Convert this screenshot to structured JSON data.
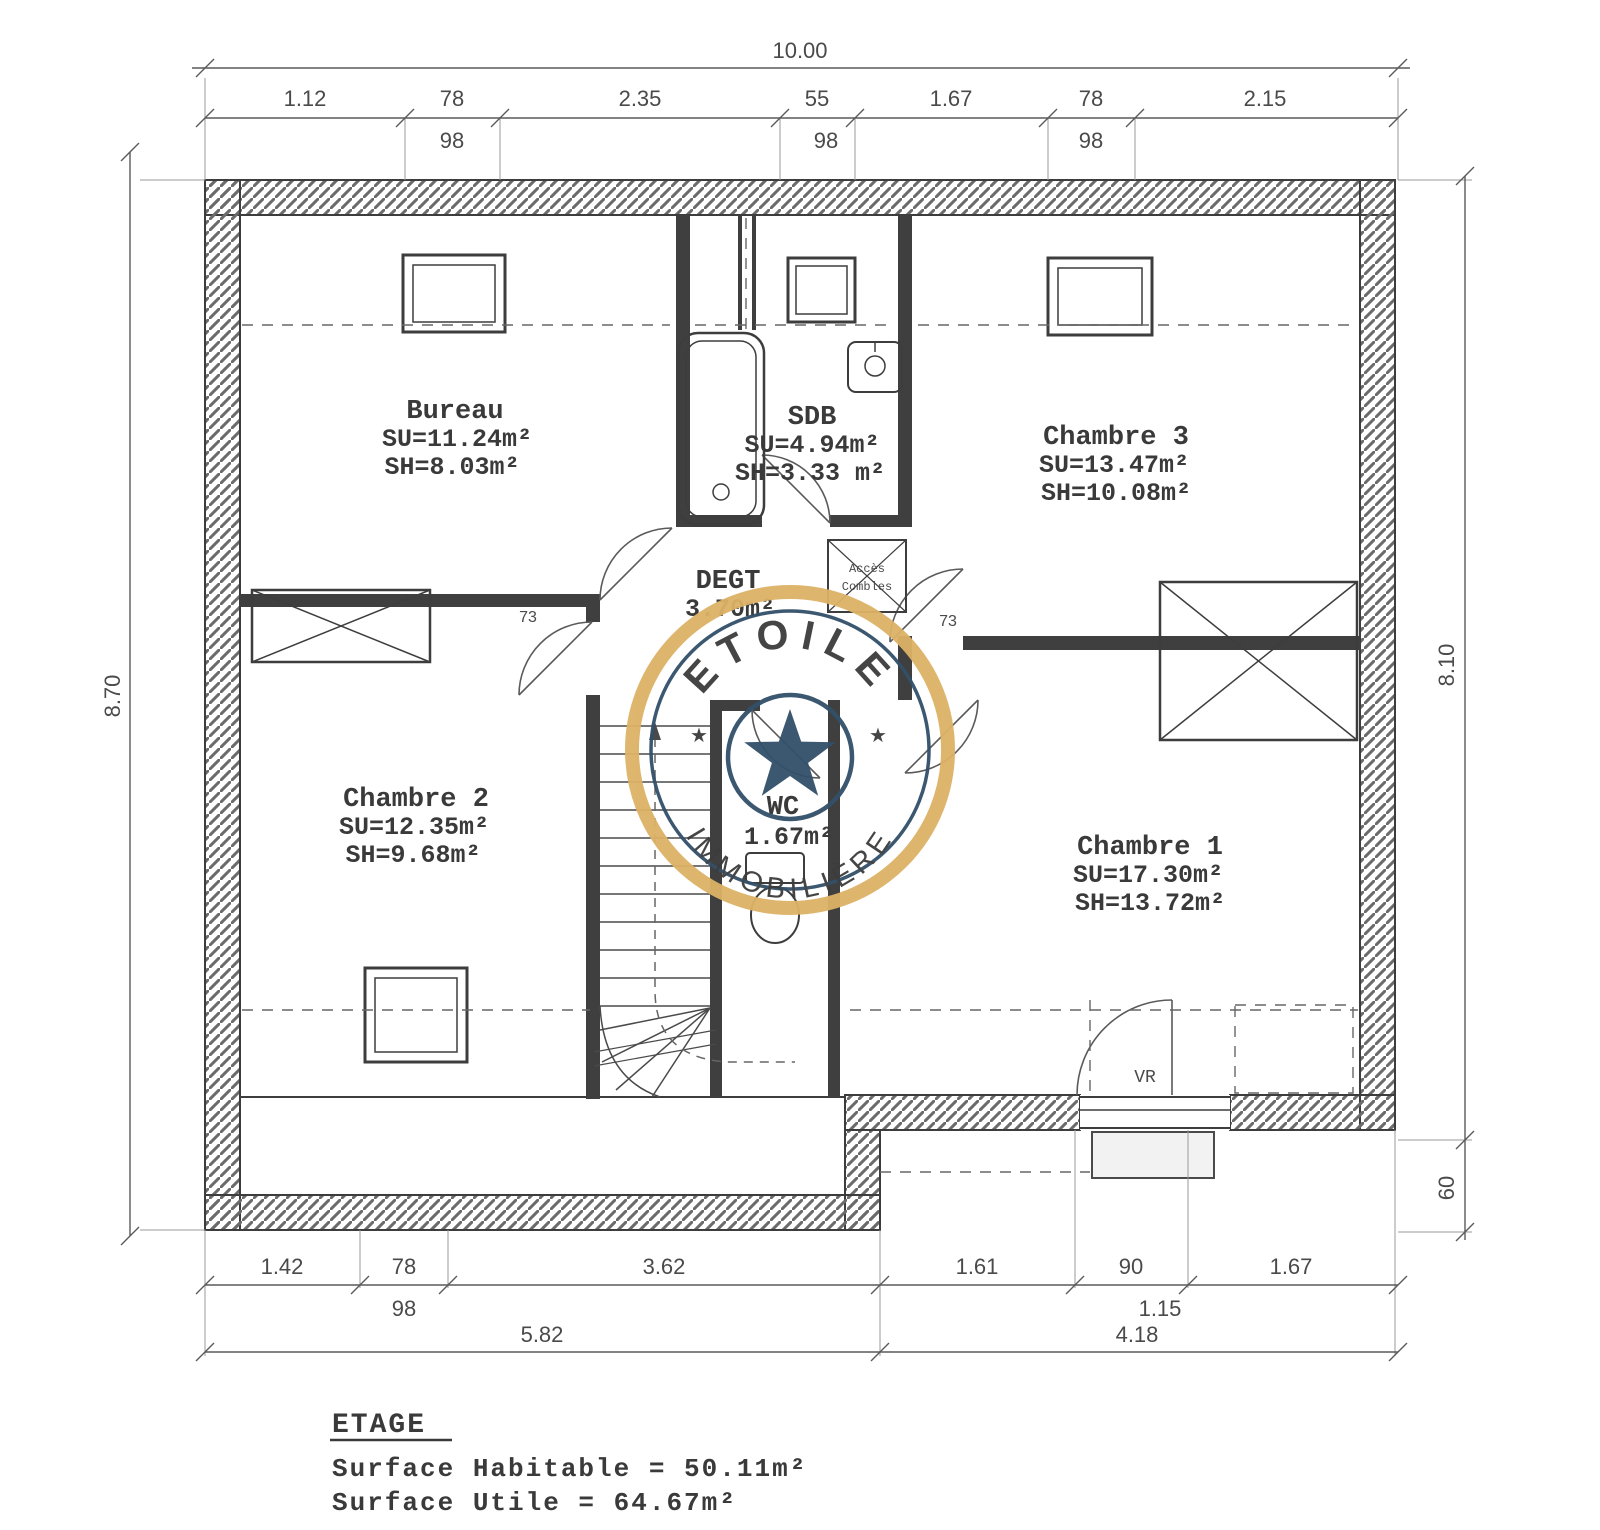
{
  "rooms": {
    "bureau": {
      "name": "Bureau",
      "su": "SU=11.24m²",
      "sh": "SH=8.03m²"
    },
    "sdb": {
      "name": "SDB",
      "su": "SU=4.94m²",
      "sh": "SH=3.33 m²"
    },
    "chambre3": {
      "name": "Chambre 3",
      "su": "SU=13.47m²",
      "sh": "SH=10.08m²"
    },
    "degt": {
      "name": "DEGT",
      "area": "3.70m²"
    },
    "chambre2": {
      "name": "Chambre 2",
      "su": "SU=12.35m²",
      "sh": "SH=9.68m²"
    },
    "wc": {
      "name": "WC",
      "area": "1.67m²"
    },
    "chambre1": {
      "name": "Chambre 1",
      "su": "SU=17.30m²",
      "sh": "SH=13.72m²"
    }
  },
  "annotations": {
    "acces_combles_line1": "Accès",
    "acces_combles_line2": "Combles",
    "vr": "VR",
    "door_width_left": "73",
    "door_width_right": "73"
  },
  "dimensions": {
    "top_total": "10.00",
    "top_segments": [
      "1.12",
      "78",
      "2.35",
      "55",
      "1.67",
      "78",
      "2.15"
    ],
    "top_subs": [
      "98",
      "98",
      "98"
    ],
    "left_total": "8.70",
    "right_total": "8.10",
    "right_offset": "60",
    "bottom_segments": [
      "1.42",
      "78",
      "3.62",
      "1.61",
      "90",
      "1.67"
    ],
    "bottom_subs": [
      "98",
      "1.15"
    ],
    "bottom_totals": [
      "5.82",
      "4.18"
    ]
  },
  "watermark": {
    "brand": "ETOILE",
    "brand_sub": "IMMOBILIÈRE",
    "star_left": "★",
    "star_right": "★",
    "gold": "#DDB266",
    "navy": "#32506A"
  },
  "summary": {
    "title": "ETAGE",
    "line1": "Surface Habitable = 50.11m²",
    "line2": "Surface Utile = 64.67m²"
  }
}
